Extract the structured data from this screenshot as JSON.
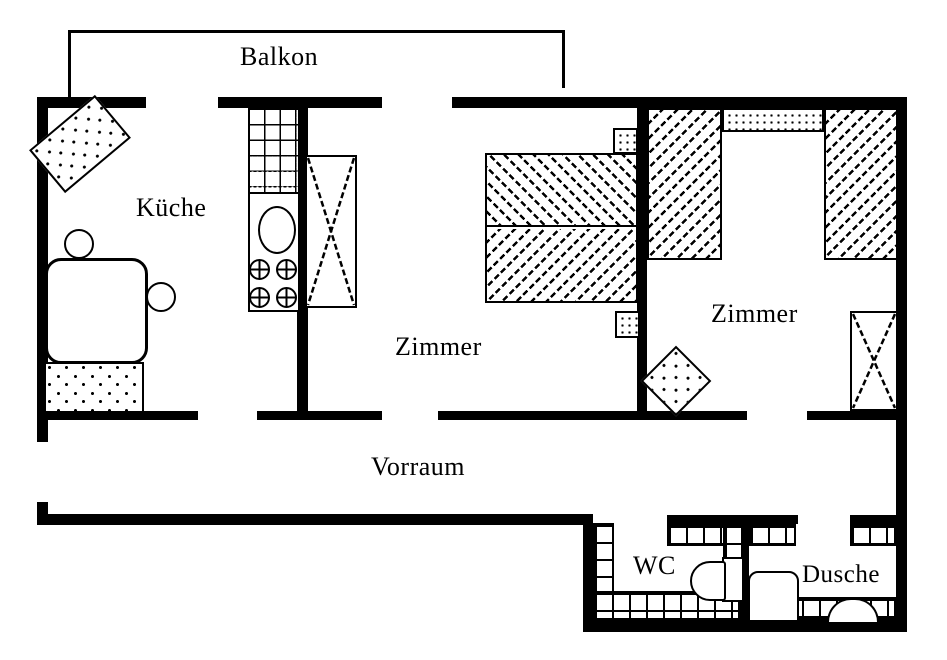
{
  "colors": {
    "line": "#000000",
    "background": "#ffffff"
  },
  "rooms": {
    "balkon": {
      "label": "Balkon"
    },
    "kueche": {
      "label": "Küche"
    },
    "zimmer_mitte": {
      "label": "Zimmer"
    },
    "zimmer_rechts": {
      "label": "Zimmer"
    },
    "vorraum": {
      "label": "Vorraum"
    },
    "wc": {
      "label": "WC"
    },
    "dusche": {
      "label": "Dusche"
    }
  },
  "furniture_icons": [
    "kitchen-rug-icon",
    "dining-table-icon",
    "chair-icon",
    "area-rug-icon",
    "counter-icon",
    "sink-icon",
    "stove-burner-icon",
    "crossed-cabinet-icon",
    "double-bed-icon",
    "nightstand-icon",
    "hatched-closet-icon",
    "dotted-shelf-icon",
    "toilet-icon",
    "shower-tray-icon",
    "washbasin-icon",
    "tile-strip-icon",
    "balcony-outline-icon"
  ]
}
